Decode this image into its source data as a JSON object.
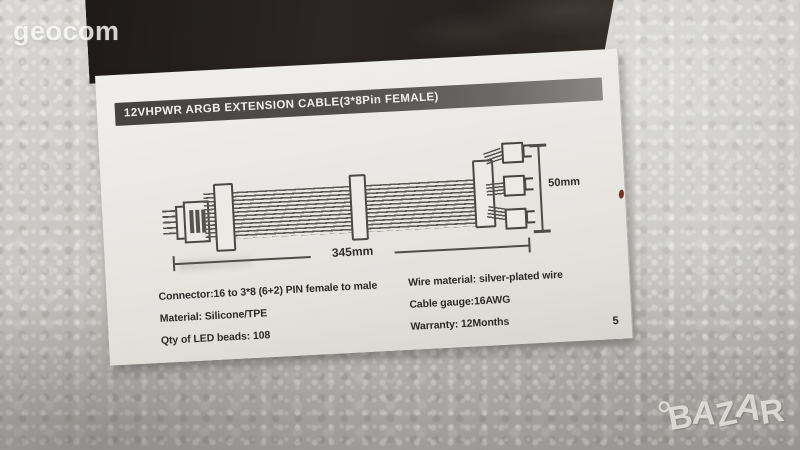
{
  "watermarks": {
    "seller": "geocom",
    "marketplace": "BAZAR"
  },
  "manual_page": {
    "header_title": "12VHPWR ARGB EXTENSION CABLE(3*8Pin FEMALE)",
    "page_number": "5",
    "diagram": {
      "length_dimension": "345mm",
      "height_dimension": "50mm"
    },
    "specs_left": [
      "Connector:16 to 3*8 (6+2) PIN female to male",
      "Material: Silicone/TPE",
      "Qty of LED beads: 108"
    ],
    "specs_right": [
      "Wire material: silver-plated wire",
      "Cable gauge:16AWG",
      "Warranty: 12Months"
    ]
  },
  "colors": {
    "foam_background": "#c3c2be",
    "cover": "#2b2624",
    "paper": "#e9e7e3",
    "header_bar": "#4a4846",
    "ink": "#2a2a28",
    "red_mark": "#6f3322"
  }
}
